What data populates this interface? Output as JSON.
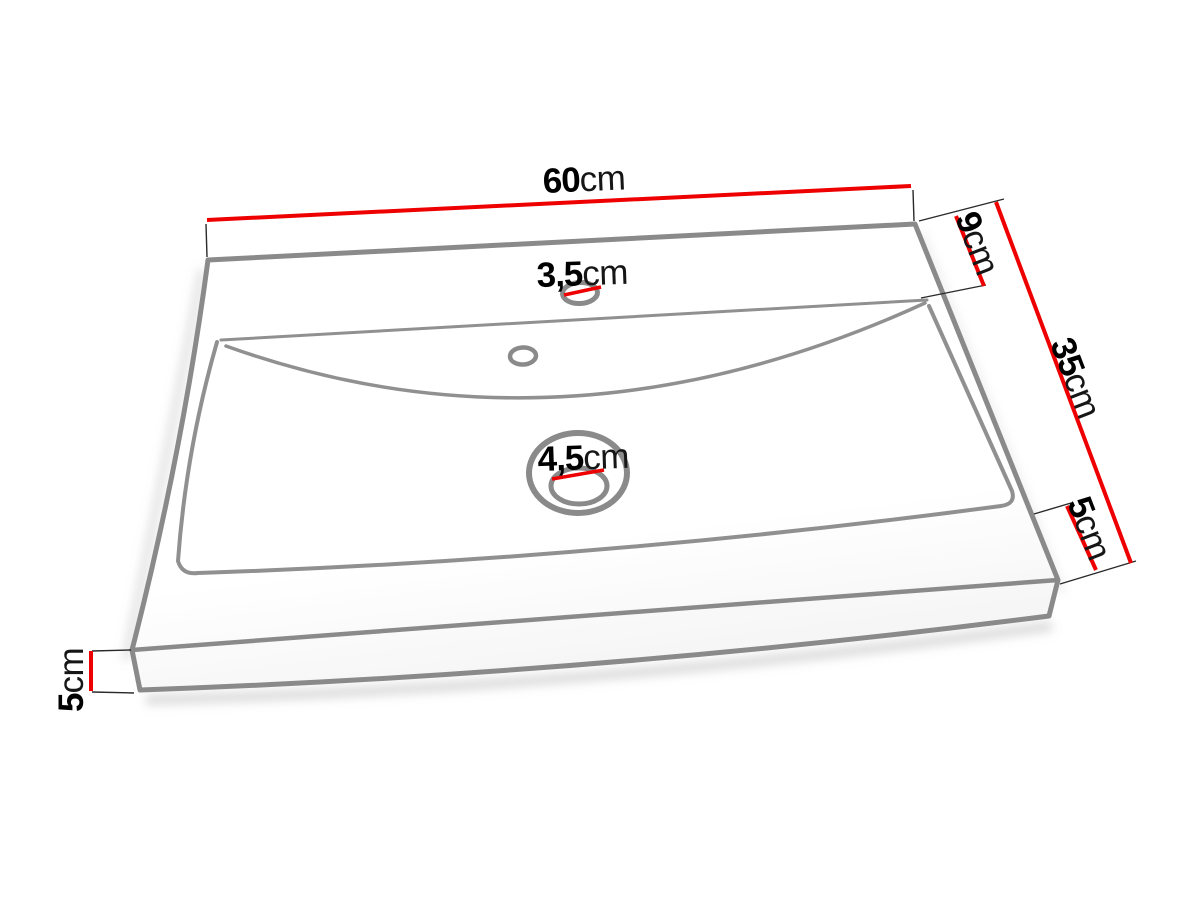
{
  "diagram": {
    "subject": "washbasin dimension drawing",
    "unit": "cm",
    "colors": {
      "dimension_line": "#ee0000",
      "outline": "#8a8a8a",
      "inner_line": "#909090",
      "extension_line": "#2a2a2a",
      "label_text": "#000000"
    },
    "dimensions": {
      "overall_width": {
        "value": "60",
        "unit": "cm"
      },
      "back_deck_depth": {
        "value": "9",
        "unit": "cm"
      },
      "overall_depth": {
        "value": "35",
        "unit": "cm"
      },
      "front_deck_depth": {
        "value": "5",
        "unit": "cm"
      },
      "edge_height": {
        "value": "5",
        "unit": "cm"
      },
      "faucet_hole_diameter": {
        "value": "3,5",
        "unit": "cm"
      },
      "drain_hole_diameter": {
        "value": "4,5",
        "unit": "cm"
      }
    }
  }
}
